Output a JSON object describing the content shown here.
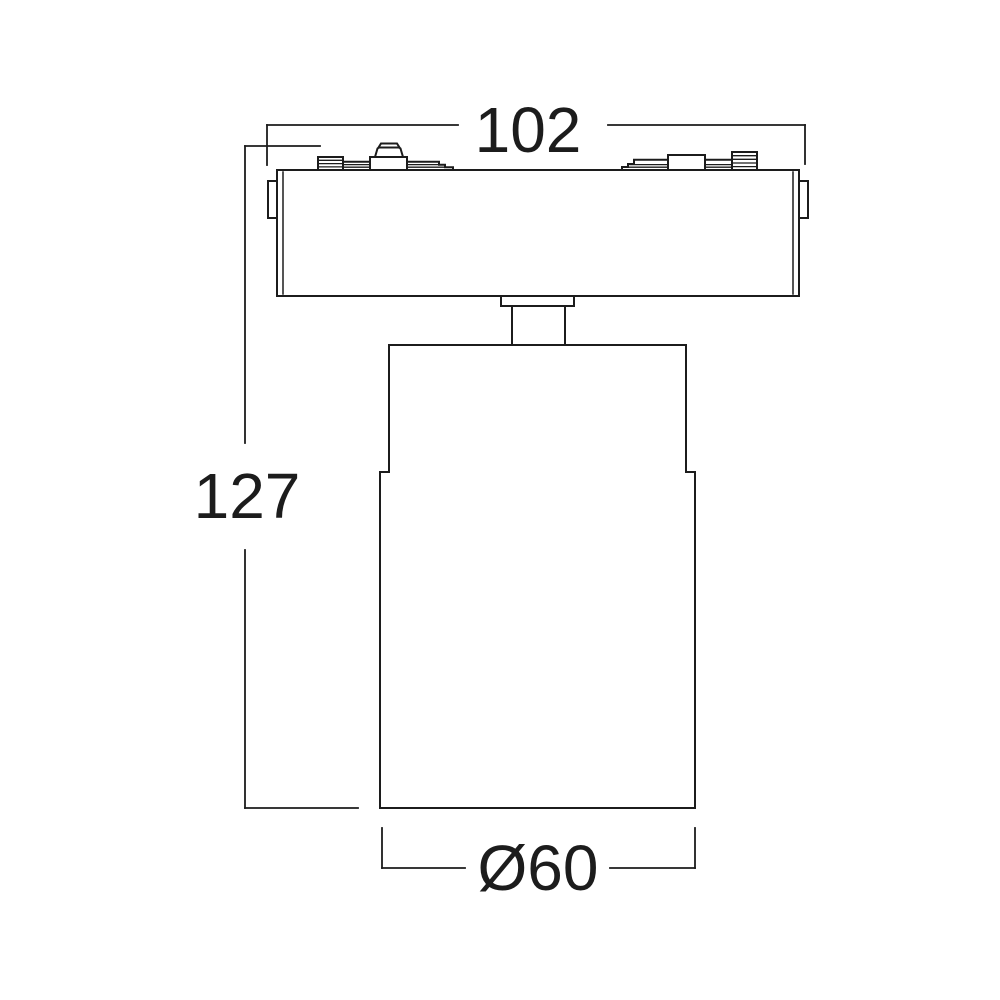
{
  "drawing": {
    "background_color": "#ffffff",
    "line_color": "#1c1c1c",
    "dimensions": {
      "width": {
        "label": "102",
        "value": 102
      },
      "height": {
        "label": "127",
        "value": 127
      },
      "diameter": {
        "label": "Ø60",
        "value": 60
      }
    }
  }
}
